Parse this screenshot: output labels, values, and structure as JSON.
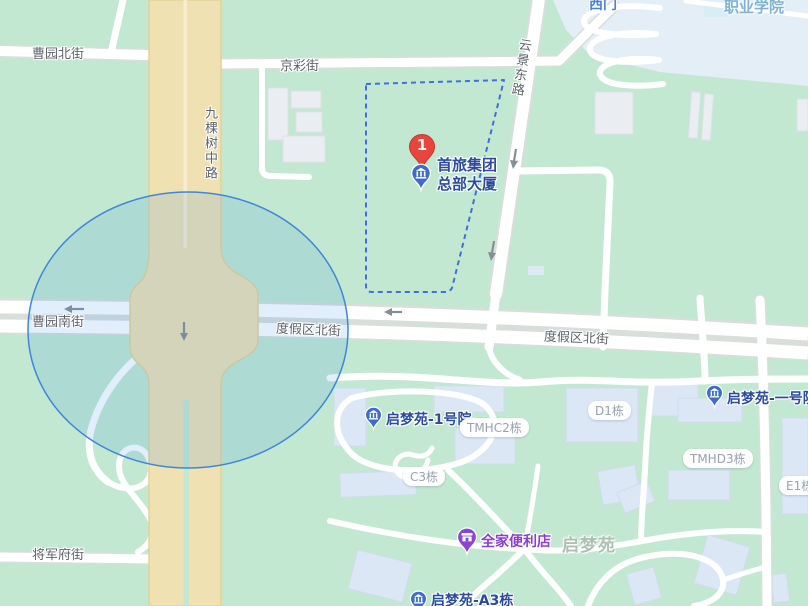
{
  "labels": {
    "streets": [
      "曹园北街",
      "京彩街",
      "九棵树中路",
      "云景东路",
      "曹园南街",
      "度假区北街",
      "度假区北街",
      "将军府街"
    ],
    "areas": {
      "campus": "职业学院",
      "residential": "启梦苑",
      "gate": "西门"
    },
    "badges": [
      "TMHC2栋",
      "C3栋",
      "D1栋",
      "TMHD3栋",
      "E1栋"
    ],
    "pois": {
      "shoulv": {
        "line1": "首旅集团",
        "line2": "总部大厦",
        "marker": "1"
      },
      "qimengyuan1": "启梦苑-1号院",
      "qimengyuan_yihao": "启梦苑-一号院",
      "familymart": "全家便利店",
      "qimengyuan_a3": "启梦苑-A3栋"
    }
  },
  "colors": {
    "land_green": "#c3e8d1",
    "campus_blue": "#e3eef6",
    "building_gray": "#eaeef2",
    "building_blue": "#dce7f6",
    "artery_tan": "#efe1b1",
    "road_white": "#ffffff",
    "poi_text_navy": "#2b4c9e",
    "familymart_purple": "#8a46d2",
    "marker_red": "#e8453c",
    "range_circle_blue": "#3f86d9",
    "boundary_dash_blue": "#4170d8"
  }
}
